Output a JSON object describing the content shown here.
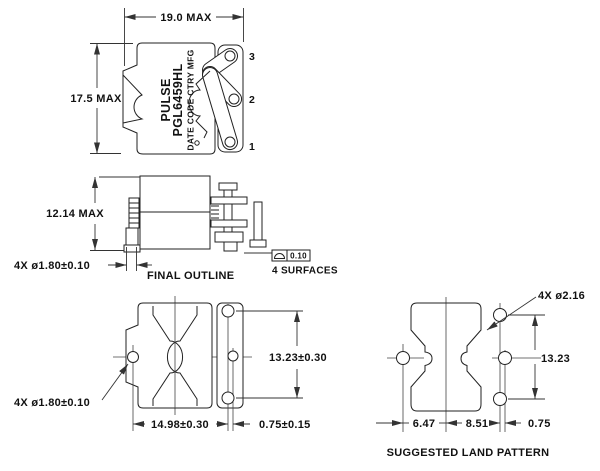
{
  "drawing": {
    "top_view": {
      "width_dim": "19.0 MAX",
      "height_dim": "17.5 MAX",
      "brand": "PULSE",
      "part_number": "PGL6459HL",
      "marking_note": "DATE CODE CTRY MFG",
      "pins": [
        "1",
        "2",
        "3"
      ]
    },
    "side_view": {
      "height_dim": "12.14 MAX",
      "lead_dim": "4X ø1.80±0.10",
      "outline_label": "FINAL OUTLINE",
      "profile_tolerance": "0.10",
      "surfaces_note": "4 SURFACES"
    },
    "bottom_view": {
      "lead_dim": "4X ø1.80±0.10",
      "pin_span_dim": "13.23±0.30",
      "pin_pitch_dim": "14.98±0.30",
      "pin_offset_dim": "0.75±0.15"
    },
    "land_pattern": {
      "pad_dim": "4X ø2.16",
      "pad_span_dim": "13.23",
      "pitch_left_dim": "6.47",
      "pitch_right_dim": "8.51",
      "offset_dim": "0.75",
      "caption": "SUGGESTED LAND PATTERN"
    }
  }
}
